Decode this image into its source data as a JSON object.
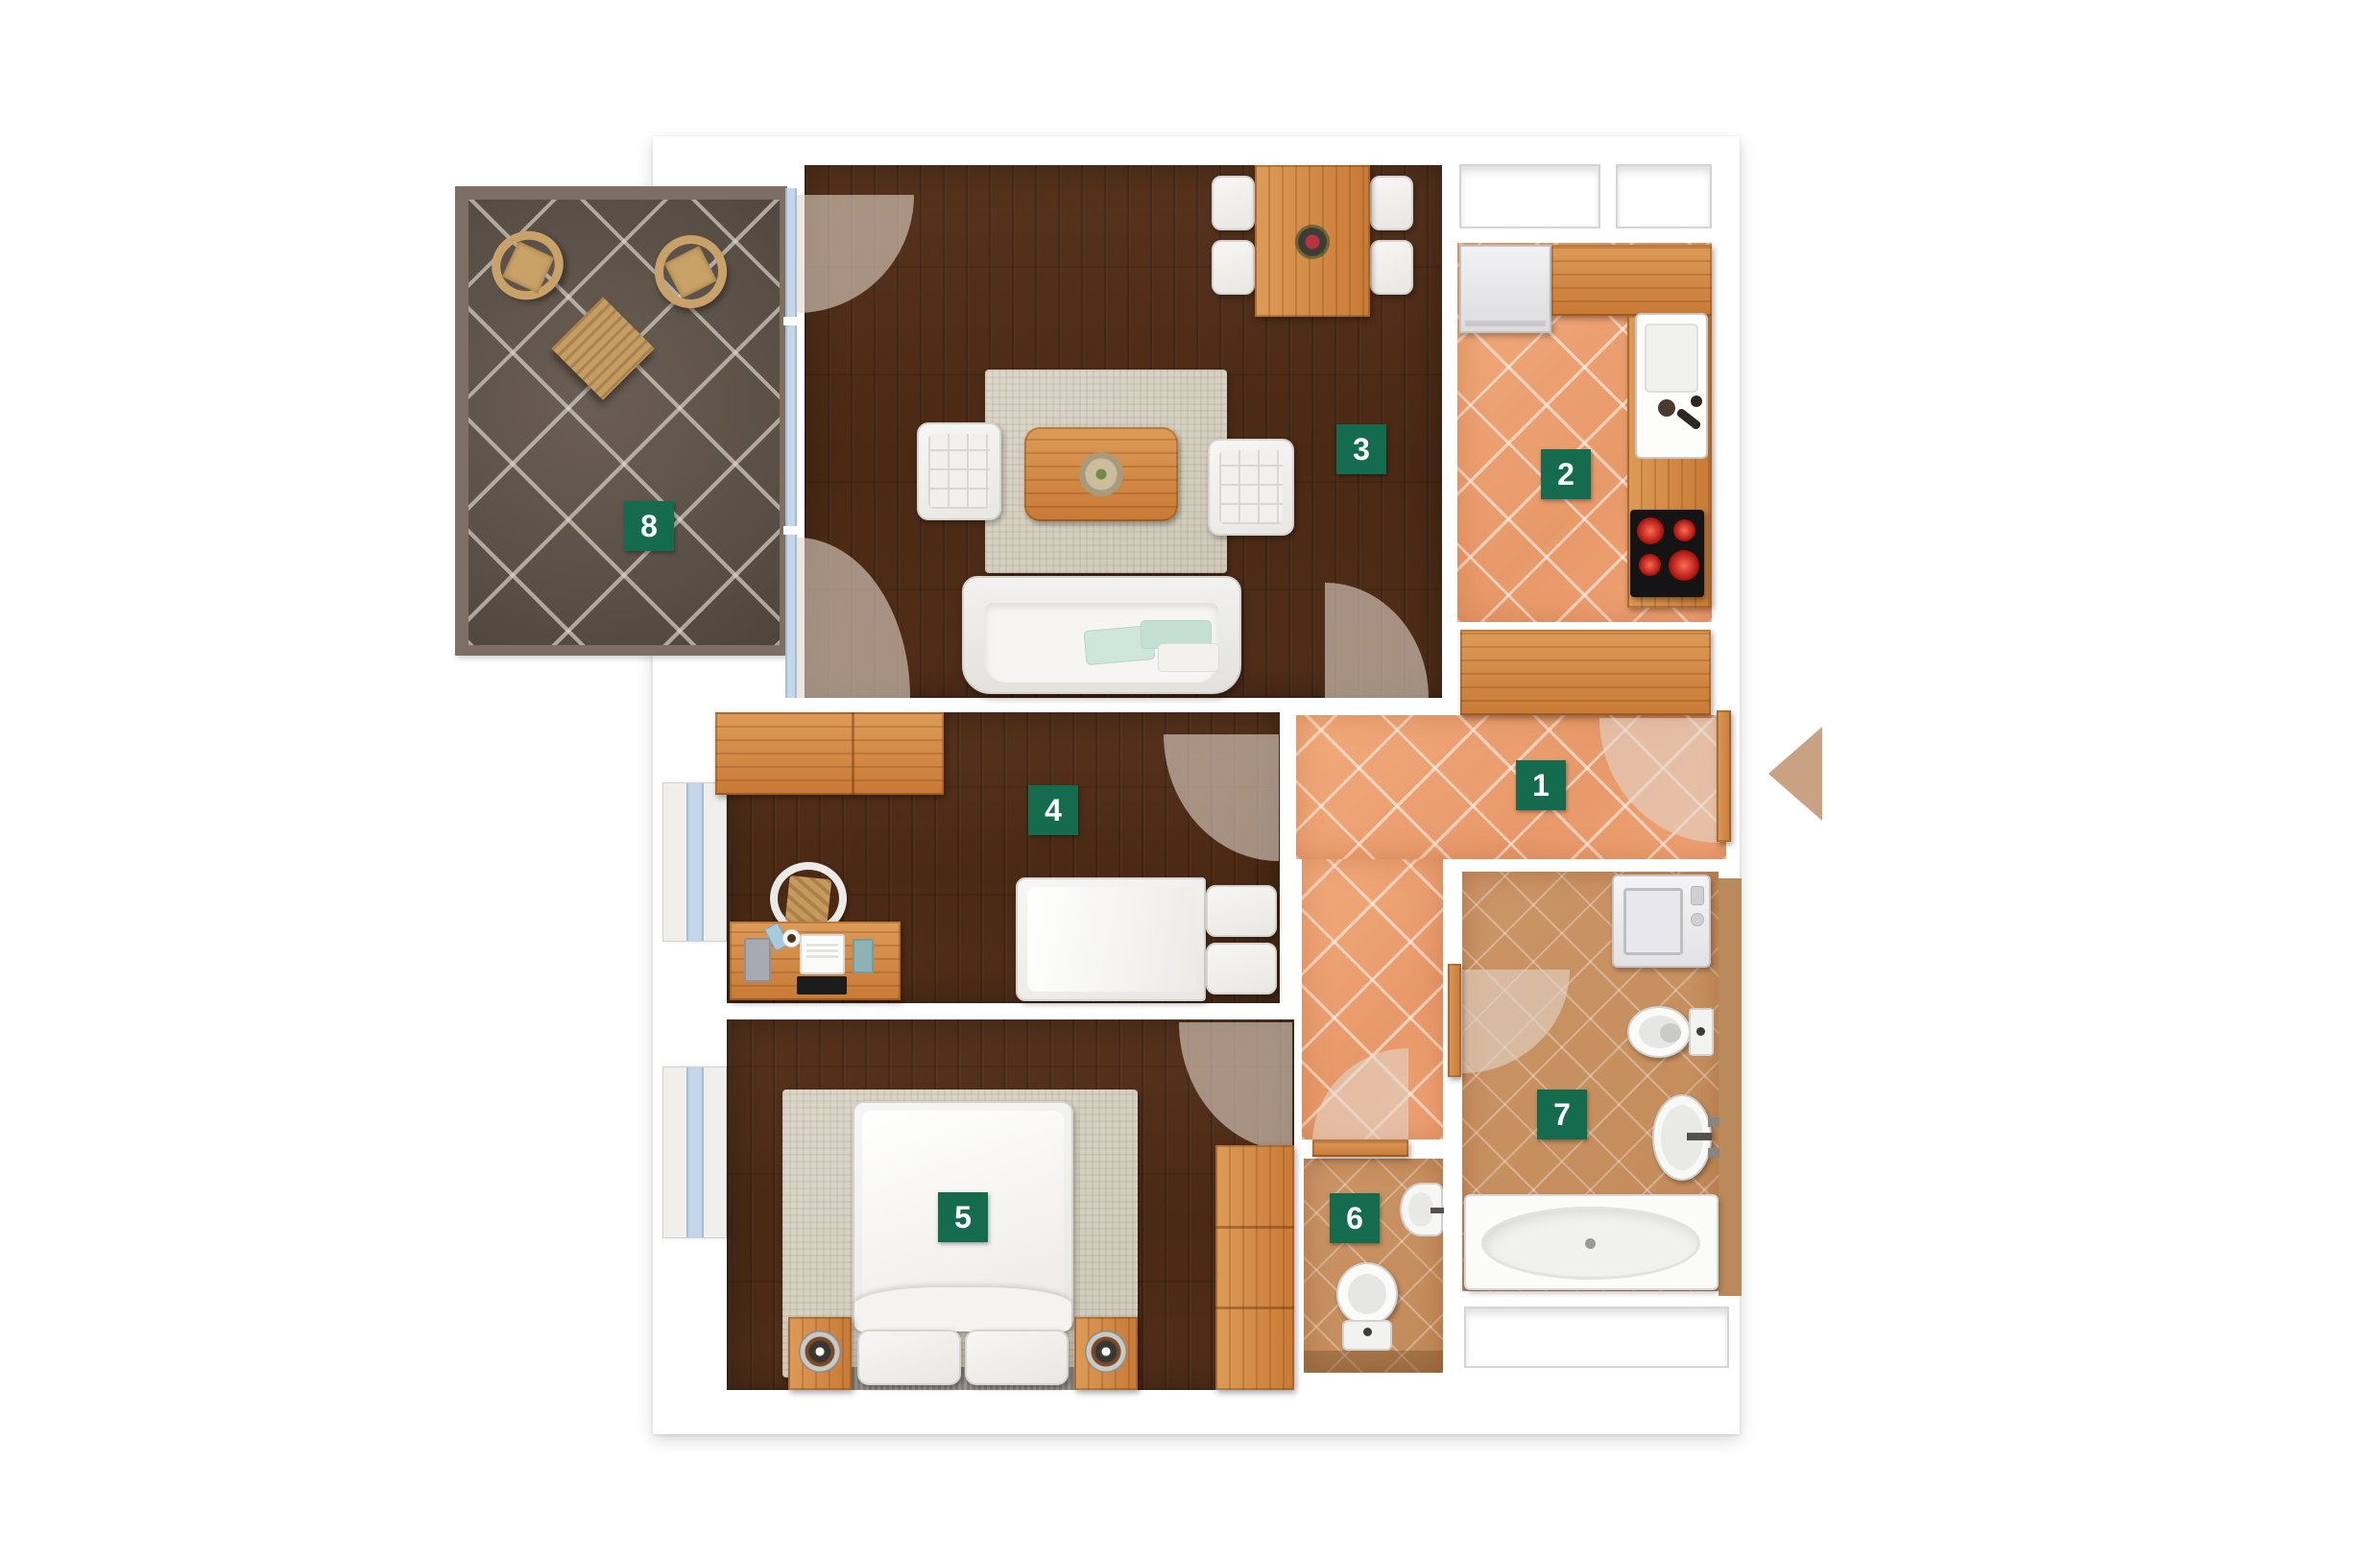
{
  "plan": {
    "type": "apartment-floor-plan",
    "rooms": [
      {
        "number": "1",
        "furniture": [
          "tiled-floor",
          "sideboard",
          "entrance-door",
          "door-swing-arc"
        ]
      },
      {
        "number": "2",
        "furniture": [
          "tiled-floor",
          "refrigerator",
          "countertop",
          "kitchen-sink",
          "cooktop",
          "two-windows"
        ]
      },
      {
        "number": "3",
        "furniture": [
          "wood-floor",
          "dining-table",
          "flower-vase",
          "four-dining-chairs",
          "area-rug",
          "coffee-table",
          "serving-bowl",
          "two-armchairs",
          "sofa",
          "cushions",
          "balcony-glass-wall",
          "door-swing-arcs"
        ]
      },
      {
        "number": "4",
        "furniture": [
          "wood-floor",
          "wardrobe",
          "desk",
          "desk-chair",
          "laptop",
          "single-bed",
          "pillows",
          "window",
          "door-swing-arc"
        ]
      },
      {
        "number": "5",
        "furniture": [
          "wood-floor",
          "double-bed",
          "pillows",
          "area-rug",
          "two-nightstands",
          "wardrobe",
          "window",
          "door-swing-arc"
        ]
      },
      {
        "number": "6",
        "furniture": [
          "tiled-floor",
          "toilet",
          "hand-basin",
          "door-swing-arc"
        ]
      },
      {
        "number": "7",
        "furniture": [
          "tiled-floor",
          "washing-machine",
          "toilet",
          "wash-basin",
          "bathtub",
          "window",
          "door-swing-arc"
        ]
      },
      {
        "number": "8",
        "furniture": [
          "tiled-floor",
          "wicker-chair",
          "wicker-chair",
          "wicker-table"
        ]
      }
    ],
    "icons": {
      "entrance_arrow": "left-pointing-triangle"
    },
    "colors": {
      "page_background": "#ffffff",
      "label_background": "#146b4d",
      "label_text": "#ffffff",
      "wood_floor": "#4e2c18",
      "oak_furniture": "#cf8444",
      "hallway_tile": "#efa678",
      "bathroom_tile": "#c99163",
      "balcony_tile": "#60554b",
      "balcony_wall": "#7d6f63",
      "window_glass": "#c3d6ea",
      "entrance_arrow": "#c9a183"
    }
  }
}
